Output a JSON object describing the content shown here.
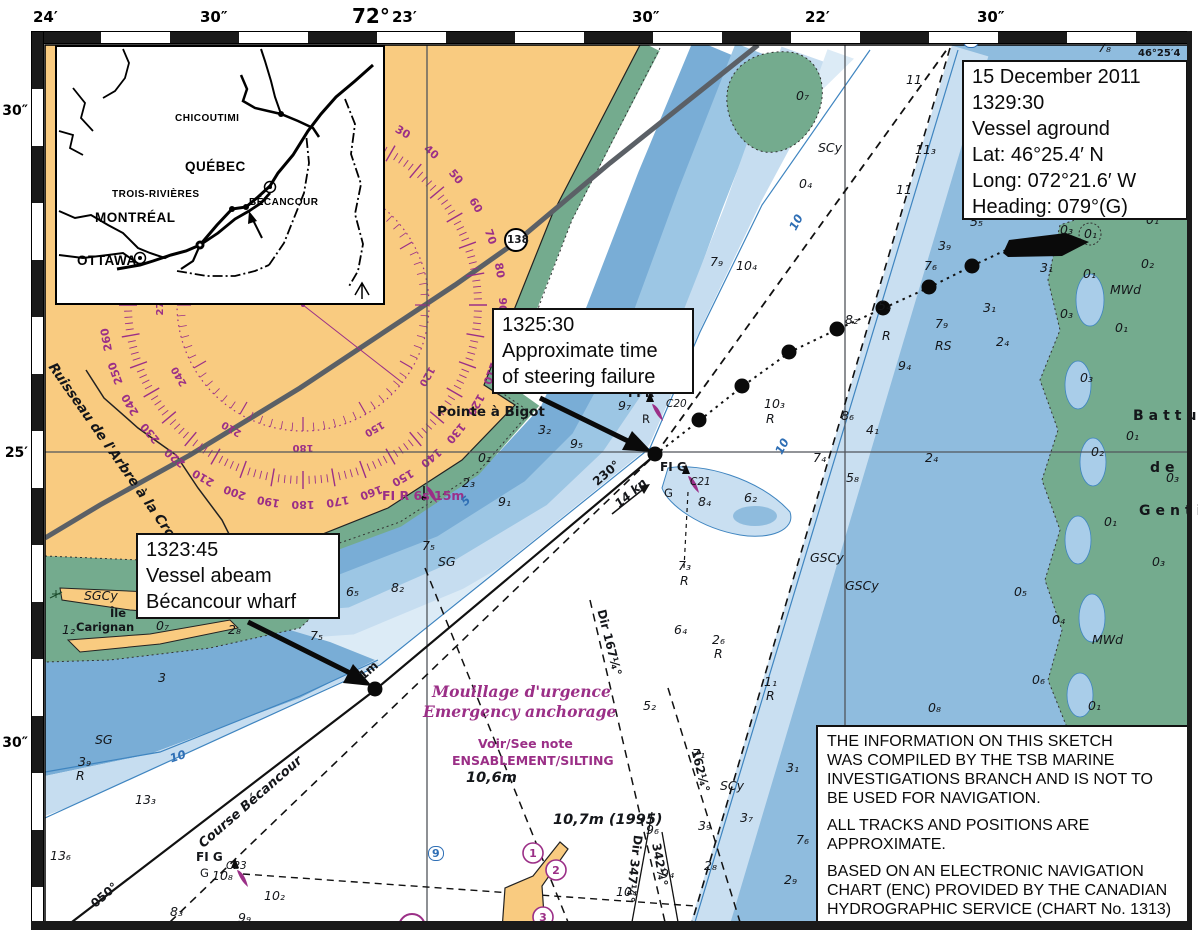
{
  "axes": {
    "top": [
      {
        "t": "24′",
        "x": 33
      },
      {
        "t": "30″",
        "x": 200
      },
      {
        "t": "72°",
        "x": 352,
        "big": 1
      },
      {
        "t": "23′",
        "x": 392
      },
      {
        "t": "30″",
        "x": 632
      },
      {
        "t": "22′",
        "x": 805
      },
      {
        "t": "30″",
        "x": 977
      }
    ],
    "left": [
      {
        "t": "30″",
        "y": 103
      },
      {
        "t": "25′",
        "y": 445
      },
      {
        "t": "30″",
        "y": 735
      }
    ]
  },
  "inset": {
    "cities": [
      {
        "t": "CHICOUTIMI",
        "x": 118,
        "y": 66,
        "b": 0
      },
      {
        "t": "QUÉBEC",
        "x": 128,
        "y": 112,
        "b": 1
      },
      {
        "t": "TROIS-RIVIÈRES",
        "x": 55,
        "y": 142,
        "b": 0
      },
      {
        "t": "BÉCANCOUR",
        "x": 192,
        "y": 150,
        "b": 0
      },
      {
        "t": "MONTRÉAL",
        "x": 38,
        "y": 163,
        "b": 1
      },
      {
        "t": "OTTAWA",
        "x": 20,
        "y": 206,
        "b": 1
      }
    ]
  },
  "boxes": {
    "aground": [
      "15 December 2011",
      "1329:30",
      "Vessel aground",
      "Lat: 46°25.4′ N",
      "Long: 072°21.6′ W",
      "Heading: 079°(G)"
    ],
    "steering": [
      "1325:30",
      "Approximate time",
      "of steering failure"
    ],
    "abeam": [
      "1323:45",
      "Vessel abeam",
      "Bécancour wharf"
    ],
    "disclaimer": [
      [
        "THE INFORMATION ON THIS SKETCH",
        "WAS COMPILED BY THE TSB MARINE",
        "INVESTIGATIONS BRANCH AND IS NOT TO",
        "BE USED FOR NAVIGATION."
      ],
      [
        "ALL TRACKS AND POSITIONS ARE",
        "APPROXIMATE."
      ],
      [
        "BASED ON AN ELECTRONIC NAVIGATION",
        "CHART (ENC) PROVIDED BY THE CANADIAN",
        "HYDROGRAPHIC SERVICE (CHART  No. 1313)"
      ]
    ]
  },
  "compass": {
    "outer": [
      30,
      40,
      50,
      60,
      70,
      80,
      90,
      100,
      110,
      120,
      130,
      140,
      150,
      160,
      170,
      180,
      190,
      200,
      210,
      220,
      230,
      240,
      250,
      260
    ],
    "inner": [
      120,
      150,
      180,
      210,
      240,
      270
    ]
  },
  "colors": {
    "magenta": "#9b2f87",
    "land": "#f9cb80",
    "intertidal": "#74ab8e",
    "deep": "#79add6",
    "mid": "#9cc6e4",
    "light": "#c6ddf0",
    "channel": "#ffffff"
  },
  "labels": [
    {
      "t": "46°25′4",
      "x": 1138,
      "y": 48,
      "c": "cr"
    },
    {
      "t": "Pointe à Bigot",
      "x": 437,
      "y": 404,
      "c": "pl"
    },
    {
      "t": "Ruisseau de l'Arbre à la Croix",
      "x": 58,
      "y": 360,
      "c": "st",
      "r": 55
    },
    {
      "t": "Île",
      "x": 110,
      "y": 606,
      "c": "ps"
    },
    {
      "t": "Carignan",
      "x": 76,
      "y": 620,
      "c": "ps"
    },
    {
      "t": "Battur",
      "x": 1133,
      "y": 408,
      "c": "rg"
    },
    {
      "t": "de",
      "x": 1150,
      "y": 460,
      "c": "rg"
    },
    {
      "t": "Gentil",
      "x": 1139,
      "y": 503,
      "c": "rg"
    },
    {
      "t": "Course Bécancour",
      "x": 196,
      "y": 840,
      "c": "cb2",
      "r": -41
    },
    {
      "t": "Mouillage d'urgence",
      "x": 432,
      "y": 682,
      "c": "mi"
    },
    {
      "t": "Emergency anchorage",
      "x": 423,
      "y": 702,
      "c": "mi"
    },
    {
      "t": "Voir/See note",
      "x": 478,
      "y": 736,
      "c": "m"
    },
    {
      "t": "ENSABLEMENT/SILTING",
      "x": 452,
      "y": 753,
      "c": "m"
    },
    {
      "t": "10,6m",
      "x": 466,
      "y": 770,
      "c": "dl"
    },
    {
      "t": "10,7m (1995)",
      "x": 553,
      "y": 812,
      "c": "dl"
    },
    {
      "t": "FI R 6s 15m",
      "x": 382,
      "y": 488,
      "c": "m"
    },
    {
      "t": "FI R",
      "x": 628,
      "y": 386,
      "c": "lt"
    },
    {
      "t": "C20",
      "x": 666,
      "y": 398,
      "c": "si"
    },
    {
      "t": "R",
      "x": 642,
      "y": 412,
      "c": "s"
    },
    {
      "t": "9₇",
      "x": 618,
      "y": 398,
      "c": "d"
    },
    {
      "t": "FI G",
      "x": 660,
      "y": 460,
      "c": "lt"
    },
    {
      "t": "C21",
      "x": 690,
      "y": 476,
      "c": "si"
    },
    {
      "t": "G",
      "x": 664,
      "y": 486,
      "c": "s"
    },
    {
      "t": "FI G",
      "x": 196,
      "y": 850,
      "c": "lt"
    },
    {
      "t": "C23",
      "x": 226,
      "y": 860,
      "c": "si"
    },
    {
      "t": "G",
      "x": 200,
      "y": 866,
      "c": "s"
    },
    {
      "t": "10₈",
      "x": 212,
      "y": 868,
      "c": "d"
    },
    {
      "t": "230°",
      "x": 590,
      "y": 478,
      "c": "rl",
      "r": -41
    },
    {
      "t": "14 kn",
      "x": 612,
      "y": 500,
      "c": "kn",
      "r": -41
    },
    {
      "t": "050°",
      "x": 88,
      "y": 900,
      "c": "rl",
      "r": -41
    },
    {
      "t": "1m",
      "x": 356,
      "y": 672,
      "c": "rl",
      "r": -41
    },
    {
      "t": "Dir 167¼°",
      "x": 608,
      "y": 608,
      "c": "rl",
      "r": 76
    },
    {
      "t": "162¼°",
      "x": 702,
      "y": 748,
      "c": "rl",
      "r": 76
    },
    {
      "t": "Dir 347¼°",
      "x": 645,
      "y": 836,
      "c": "rl",
      "r": 97
    },
    {
      "t": "342¼°",
      "x": 663,
      "y": 842,
      "c": "rl",
      "r": 80
    },
    {
      "t": "138",
      "x": 507,
      "y": 234,
      "c": "rt"
    },
    {
      "t": "9",
      "x": 963,
      "y": 33,
      "c": "cbx"
    },
    {
      "t": "9",
      "x": 428,
      "y": 846,
      "c": "cbx"
    },
    {
      "t": "10",
      "x": 772,
      "y": 450,
      "c": "ct",
      "r": -62
    },
    {
      "t": "10",
      "x": 168,
      "y": 752,
      "c": "ct",
      "r": -18
    },
    {
      "t": "10",
      "x": 786,
      "y": 226,
      "c": "ct",
      "r": -62
    },
    {
      "t": "5",
      "x": 458,
      "y": 498,
      "c": "ct",
      "r": -40
    },
    {
      "t": "SCy",
      "x": 818,
      "y": 140,
      "c": "sb"
    },
    {
      "t": "SCy",
      "x": 720,
      "y": 778,
      "c": "sb"
    },
    {
      "t": "SGCy",
      "x": 84,
      "y": 588,
      "c": "sb"
    },
    {
      "t": "SG",
      "x": 95,
      "y": 732,
      "c": "sb"
    },
    {
      "t": "SG",
      "x": 438,
      "y": 554,
      "c": "sb"
    },
    {
      "t": "GSCy",
      "x": 810,
      "y": 550,
      "c": "sb"
    },
    {
      "t": "GSCy",
      "x": 845,
      "y": 578,
      "c": "sb"
    },
    {
      "t": "RS",
      "x": 935,
      "y": 338,
      "c": "sb"
    },
    {
      "t": "MWd",
      "x": 1110,
      "y": 282,
      "c": "sb"
    },
    {
      "t": "MWd",
      "x": 1092,
      "y": 632,
      "c": "sb"
    },
    {
      "t": "0₇",
      "x": 796,
      "y": 88,
      "c": "d"
    },
    {
      "t": "11",
      "x": 906,
      "y": 72,
      "c": "d"
    },
    {
      "t": "11₃",
      "x": 915,
      "y": 142,
      "c": "d"
    },
    {
      "t": "0₄",
      "x": 799,
      "y": 176,
      "c": "d"
    },
    {
      "t": "11",
      "x": 896,
      "y": 182,
      "c": "d"
    },
    {
      "t": "0₃",
      "x": 1034,
      "y": 110,
      "c": "d"
    },
    {
      "t": "0₉",
      "x": 1080,
      "y": 174,
      "c": "d"
    },
    {
      "t": "7₈",
      "x": 1098,
      "y": 40,
      "c": "d"
    },
    {
      "t": "3₇",
      "x": 1166,
      "y": 80,
      "c": "d"
    },
    {
      "t": "3₇",
      "x": 1158,
      "y": 126,
      "c": "d"
    },
    {
      "t": "0₉",
      "x": 1168,
      "y": 160,
      "c": "d"
    },
    {
      "t": "0₁",
      "x": 1146,
      "y": 212,
      "c": "d"
    },
    {
      "t": "5₅",
      "x": 970,
      "y": 214,
      "c": "d"
    },
    {
      "t": "3₉",
      "x": 938,
      "y": 238,
      "c": "d"
    },
    {
      "t": "7₆",
      "x": 924,
      "y": 258,
      "c": "d"
    },
    {
      "t": "0₃",
      "x": 1060,
      "y": 222,
      "c": "d"
    },
    {
      "t": "0₁",
      "x": 1084,
      "y": 226,
      "c": "d"
    },
    {
      "t": "0₂",
      "x": 1141,
      "y": 256,
      "c": "d"
    },
    {
      "t": "3₁",
      "x": 1040,
      "y": 260,
      "c": "d"
    },
    {
      "t": "0₁",
      "x": 1083,
      "y": 266,
      "c": "d"
    },
    {
      "t": "3₁",
      "x": 983,
      "y": 300,
      "c": "d"
    },
    {
      "t": "0₃",
      "x": 1060,
      "y": 306,
      "c": "d"
    },
    {
      "t": "0₁",
      "x": 1115,
      "y": 320,
      "c": "d"
    },
    {
      "t": "2₄",
      "x": 996,
      "y": 334,
      "c": "d"
    },
    {
      "t": "7₉",
      "x": 935,
      "y": 316,
      "c": "d"
    },
    {
      "t": "8₂",
      "x": 845,
      "y": 312,
      "c": "d"
    },
    {
      "t": "5₄",
      "x": 878,
      "y": 298,
      "c": "d"
    },
    {
      "t": "R",
      "x": 882,
      "y": 328,
      "c": "d"
    },
    {
      "t": "9₄",
      "x": 898,
      "y": 358,
      "c": "d"
    },
    {
      "t": "7₉",
      "x": 710,
      "y": 254,
      "c": "d"
    },
    {
      "t": "10₄",
      "x": 736,
      "y": 258,
      "c": "d"
    },
    {
      "t": "10₃",
      "x": 764,
      "y": 396,
      "c": "d"
    },
    {
      "t": "R",
      "x": 766,
      "y": 411,
      "c": "d"
    },
    {
      "t": "8₄",
      "x": 698,
      "y": 494,
      "c": "d"
    },
    {
      "t": "6₂",
      "x": 744,
      "y": 490,
      "c": "d"
    },
    {
      "t": "7₄",
      "x": 813,
      "y": 450,
      "c": "d"
    },
    {
      "t": "2₄",
      "x": 925,
      "y": 450,
      "c": "d"
    },
    {
      "t": "5₈",
      "x": 846,
      "y": 470,
      "c": "d"
    },
    {
      "t": "8₆",
      "x": 841,
      "y": 408,
      "c": "d"
    },
    {
      "t": "4₁",
      "x": 866,
      "y": 422,
      "c": "d"
    },
    {
      "t": "0₂",
      "x": 1091,
      "y": 444,
      "c": "d"
    },
    {
      "t": "0₃",
      "x": 1080,
      "y": 370,
      "c": "d"
    },
    {
      "t": "0₁",
      "x": 1126,
      "y": 428,
      "c": "d"
    },
    {
      "t": "0₃",
      "x": 1166,
      "y": 470,
      "c": "d"
    },
    {
      "t": "0₁",
      "x": 1104,
      "y": 514,
      "c": "d"
    },
    {
      "t": "3₂",
      "x": 538,
      "y": 422,
      "c": "d"
    },
    {
      "t": "9₅",
      "x": 570,
      "y": 436,
      "c": "d"
    },
    {
      "t": "0₁",
      "x": 478,
      "y": 450,
      "c": "d"
    },
    {
      "t": "2₃",
      "x": 462,
      "y": 475,
      "c": "d"
    },
    {
      "t": "9₁",
      "x": 498,
      "y": 494,
      "c": "d"
    },
    {
      "t": "7₅",
      "x": 422,
      "y": 538,
      "c": "d"
    },
    {
      "t": "6₅",
      "x": 346,
      "y": 584,
      "c": "d"
    },
    {
      "t": "8₂",
      "x": 391,
      "y": 580,
      "c": "d"
    },
    {
      "t": "0₄",
      "x": 306,
      "y": 558,
      "c": "d"
    },
    {
      "t": "0₇",
      "x": 156,
      "y": 618,
      "c": "d"
    },
    {
      "t": "2₈",
      "x": 228,
      "y": 622,
      "c": "d"
    },
    {
      "t": "7₅",
      "x": 310,
      "y": 628,
      "c": "d"
    },
    {
      "t": "3",
      "x": 158,
      "y": 670,
      "c": "d"
    },
    {
      "t": "1₂",
      "x": 62,
      "y": 622,
      "c": "d"
    },
    {
      "t": "3₉",
      "x": 78,
      "y": 754,
      "c": "d"
    },
    {
      "t": "R",
      "x": 76,
      "y": 768,
      "c": "d"
    },
    {
      "t": "13₃",
      "x": 135,
      "y": 792,
      "c": "d"
    },
    {
      "t": "13₆",
      "x": 50,
      "y": 848,
      "c": "d"
    },
    {
      "t": "10₂",
      "x": 264,
      "y": 888,
      "c": "d"
    },
    {
      "t": "8₃",
      "x": 170,
      "y": 904,
      "c": "d"
    },
    {
      "t": "9₉",
      "x": 238,
      "y": 910,
      "c": "d"
    },
    {
      "t": "9₆",
      "x": 646,
      "y": 822,
      "c": "d"
    },
    {
      "t": "9₄",
      "x": 661,
      "y": 866,
      "c": "d"
    },
    {
      "t": "10₄",
      "x": 616,
      "y": 884,
      "c": "d"
    },
    {
      "t": "5₂",
      "x": 643,
      "y": 698,
      "c": "d"
    },
    {
      "t": "7₁",
      "x": 692,
      "y": 746,
      "c": "d"
    },
    {
      "t": "7₃",
      "x": 678,
      "y": 558,
      "c": "d"
    },
    {
      "t": "R",
      "x": 680,
      "y": 573,
      "c": "d"
    },
    {
      "t": "6₄",
      "x": 674,
      "y": 622,
      "c": "d"
    },
    {
      "t": "2₆",
      "x": 712,
      "y": 632,
      "c": "d"
    },
    {
      "t": "R",
      "x": 714,
      "y": 646,
      "c": "d"
    },
    {
      "t": "1₁",
      "x": 764,
      "y": 674,
      "c": "d"
    },
    {
      "t": "R",
      "x": 766,
      "y": 688,
      "c": "d"
    },
    {
      "t": "3₁",
      "x": 786,
      "y": 760,
      "c": "d"
    },
    {
      "t": "3₇",
      "x": 740,
      "y": 810,
      "c": "d"
    },
    {
      "t": "3₉",
      "x": 698,
      "y": 818,
      "c": "d"
    },
    {
      "t": "2₈",
      "x": 704,
      "y": 858,
      "c": "d"
    },
    {
      "t": "2₉",
      "x": 784,
      "y": 872,
      "c": "d"
    },
    {
      "t": "7₆",
      "x": 796,
      "y": 832,
      "c": "d"
    },
    {
      "t": "0₅",
      "x": 1014,
      "y": 584,
      "c": "d"
    },
    {
      "t": "0₄",
      "x": 1052,
      "y": 612,
      "c": "d"
    },
    {
      "t": "0₆",
      "x": 1032,
      "y": 672,
      "c": "d"
    },
    {
      "t": "0₃",
      "x": 1152,
      "y": 554,
      "c": "d"
    },
    {
      "t": "0₈",
      "x": 928,
      "y": 700,
      "c": "d"
    },
    {
      "t": "0₁",
      "x": 1088,
      "y": 698,
      "c": "d"
    }
  ]
}
